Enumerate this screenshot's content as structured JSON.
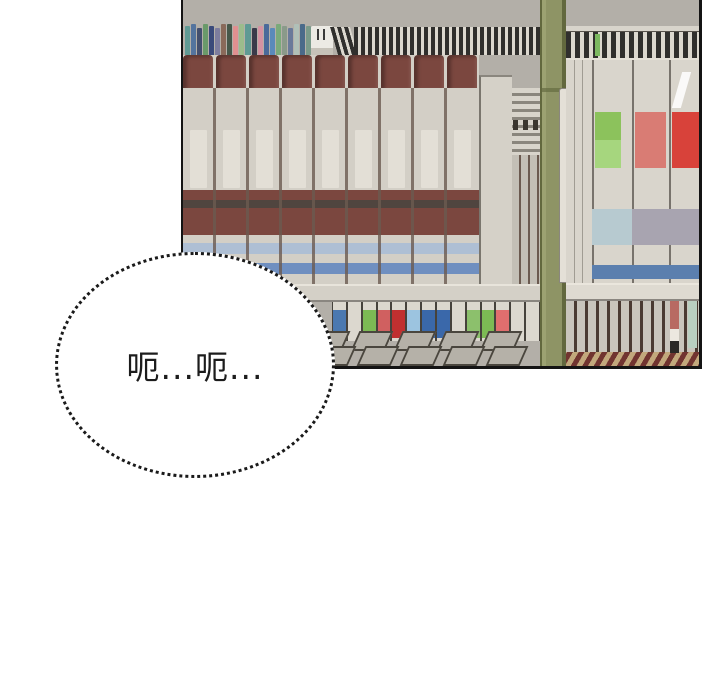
{
  "bubble": {
    "text": "呃...呃..."
  },
  "palette": {
    "bd": "#141414",
    "wall": "#b3afa8",
    "cap": "#7b473f",
    "spine": "#d3cfc6",
    "sep": "#6b5a50",
    "maroon": "#7b473f",
    "dstripe": "#4a4540",
    "paleblue": "#aebfd4",
    "blueband": "#6f8fc0",
    "column": "#d5d1c8",
    "slatl": "#d8d4cb",
    "slatd": "#8a867d",
    "midlow": "#c3bfb6",
    "pillar": "#8e9465",
    "pillard": "#62683e",
    "pillarl": "#9ca272",
    "rail": "#d8d4cb",
    "thind": "#302f2d",
    "thinl": "#dcd8cf",
    "spinebg": "#d9d5cc",
    "greensliver": "#7cb860",
    "greenpatch1": "#8cc25c",
    "greenpatch2": "#a6d67e",
    "pinkpatch": "#d97c74",
    "redpatch": "#d8423a",
    "bandblue": "#b7cad0",
    "bandgray": "#a8a4b0",
    "bluestripe": "#5b7fae",
    "botlight": "#c9c5bc",
    "botdark": "#4a3a32",
    "pinkbook": "#b86a62",
    "greenbook": "#b9cfc0",
    "rowgap": "#46423c",
    "rowbook": "#dcd8cf",
    "slant": "#b5b1a8",
    "slantedge": "#4a463e",
    "tan": "#c2a87c",
    "floorstripe": "#713430",
    "shelf": "#d4d0c7",
    "shelfhi": "#e8e4db",
    "shelflo": "#8a8680",
    "bubbleborder": "#1a1a1a",
    "bubblefill": "#ffffff",
    "textcolor": "#1c1c1c"
  },
  "scene": {
    "small_book_colors": [
      "#5f9a94",
      "#54749e",
      "#444f6e",
      "#6a9a6a",
      "#3a4a7a",
      "#7d7d9e",
      "#8a6a5a",
      "#47584a",
      "#e09090",
      "#9cbc8c",
      "#5f9a94",
      "#3a3a4a",
      "#d492a2",
      "#4a6a9a",
      "#5a8aba",
      "#7aaa7a",
      "#8a9a8a",
      "#6a7a9a",
      "#b0c0b8",
      "#4a6a8a",
      "#7a9a8a"
    ],
    "binder_count": 9,
    "bottom_row_patches": [
      "#4a78b0",
      null,
      "#7cba54",
      "#d06060",
      "#c03030",
      "#9cc4e0",
      "#3a68aa",
      "#3a68aa",
      null,
      "#8cc06c",
      "#7cba54",
      "#e06e6e",
      null,
      null
    ],
    "slant_back_count": 8,
    "slant_front_count": 8
  }
}
